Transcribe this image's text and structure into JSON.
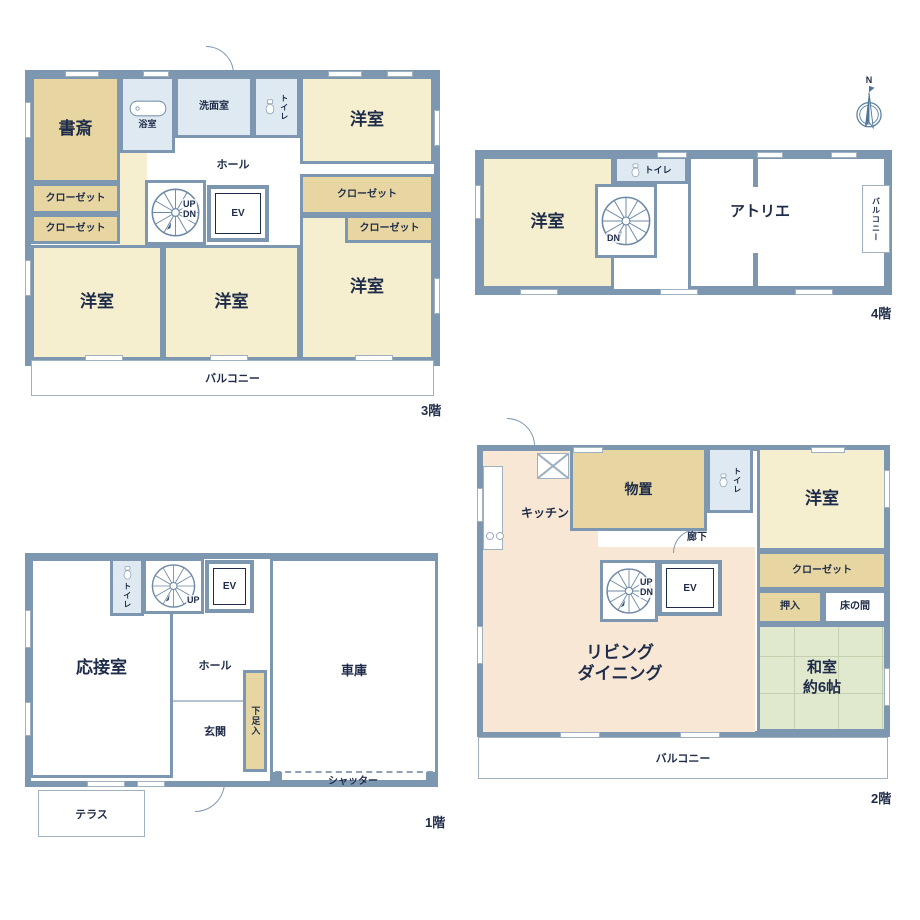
{
  "palette": {
    "wall": "#7e97b1",
    "ink": "#1f2c49",
    "cream": "#f6efcf",
    "tan": "#e8d6a2",
    "blue": "#dfe9f2",
    "peach": "#f8e7d4",
    "green": "#e0e8cd",
    "line": "#9fb0c0"
  },
  "compass": {
    "north": "N"
  },
  "floors": {
    "f3": {
      "tag": "3階",
      "labels": {
        "study": "書斎",
        "bath": "浴室",
        "washroom": "洗面室",
        "toilet": "トイレ",
        "bedroom_ne": "洋室",
        "closet_l1": "クローゼット",
        "closet_l2": "クローゼット",
        "closet_r1": "クローゼット",
        "closet_r2": "クローゼット",
        "hall": "ホール",
        "up": "UP",
        "dn": "DN",
        "ev": "EV",
        "bedroom_sw": "洋室",
        "bedroom_s": "洋室",
        "bedroom_se": "洋室",
        "balcony": "バルコニー"
      }
    },
    "f4": {
      "tag": "4階",
      "labels": {
        "bedroom": "洋室",
        "toilet": "トイレ",
        "dn": "DN",
        "atelier": "アトリエ",
        "balcony": "バルコニー"
      }
    },
    "f1": {
      "tag": "1階",
      "labels": {
        "reception": "応接室",
        "toilet": "トイレ",
        "up": "UP",
        "ev": "EV",
        "hall": "ホール",
        "entrance": "玄関",
        "shoe_cabinet": "下足入",
        "garage": "車庫",
        "shutter": "シャッター",
        "terrace": "テラス"
      }
    },
    "f2": {
      "tag": "2階",
      "labels": {
        "kitchen": "キッチン",
        "storage": "物置",
        "toilet": "トイレ",
        "bedroom": "洋室",
        "corridor": "廊下",
        "closet": "クローゼット",
        "oshiire": "押入",
        "tokonoma": "床の間",
        "washitsu_line1": "和室",
        "washitsu_line2": "約6帖",
        "living_line1": "リビング",
        "living_line2": "ダイニング",
        "up": "UP",
        "dn": "DN",
        "ev": "EV",
        "balcony": "バルコニー"
      }
    }
  }
}
